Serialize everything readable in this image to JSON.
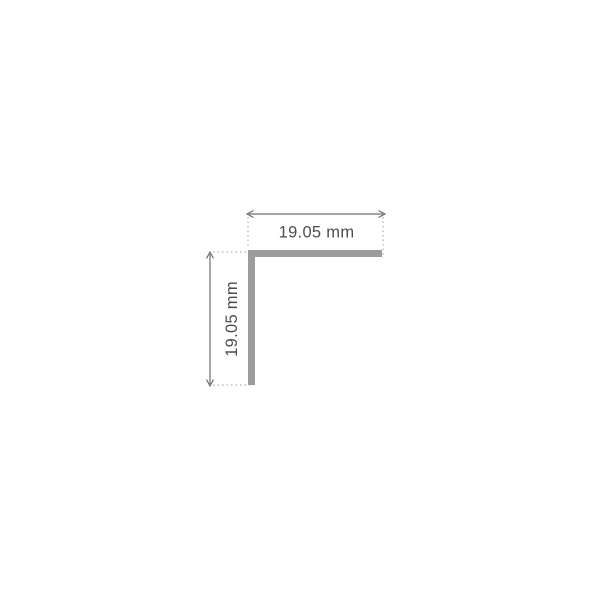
{
  "diagram": {
    "type": "technical-drawing",
    "subject": "equal-angle-profile-cross-section",
    "dimensions": {
      "width": {
        "label": "19.05 mm",
        "value": 19.05,
        "unit": "mm"
      },
      "height": {
        "label": "19.05 mm",
        "value": 19.05,
        "unit": "mm"
      }
    },
    "colors": {
      "background": "#ffffff",
      "profile": "#9c9c9c",
      "dimension_line": "#6f6f6f",
      "extension_line": "#9f9f9f",
      "text": "#4d4d4d"
    }
  }
}
